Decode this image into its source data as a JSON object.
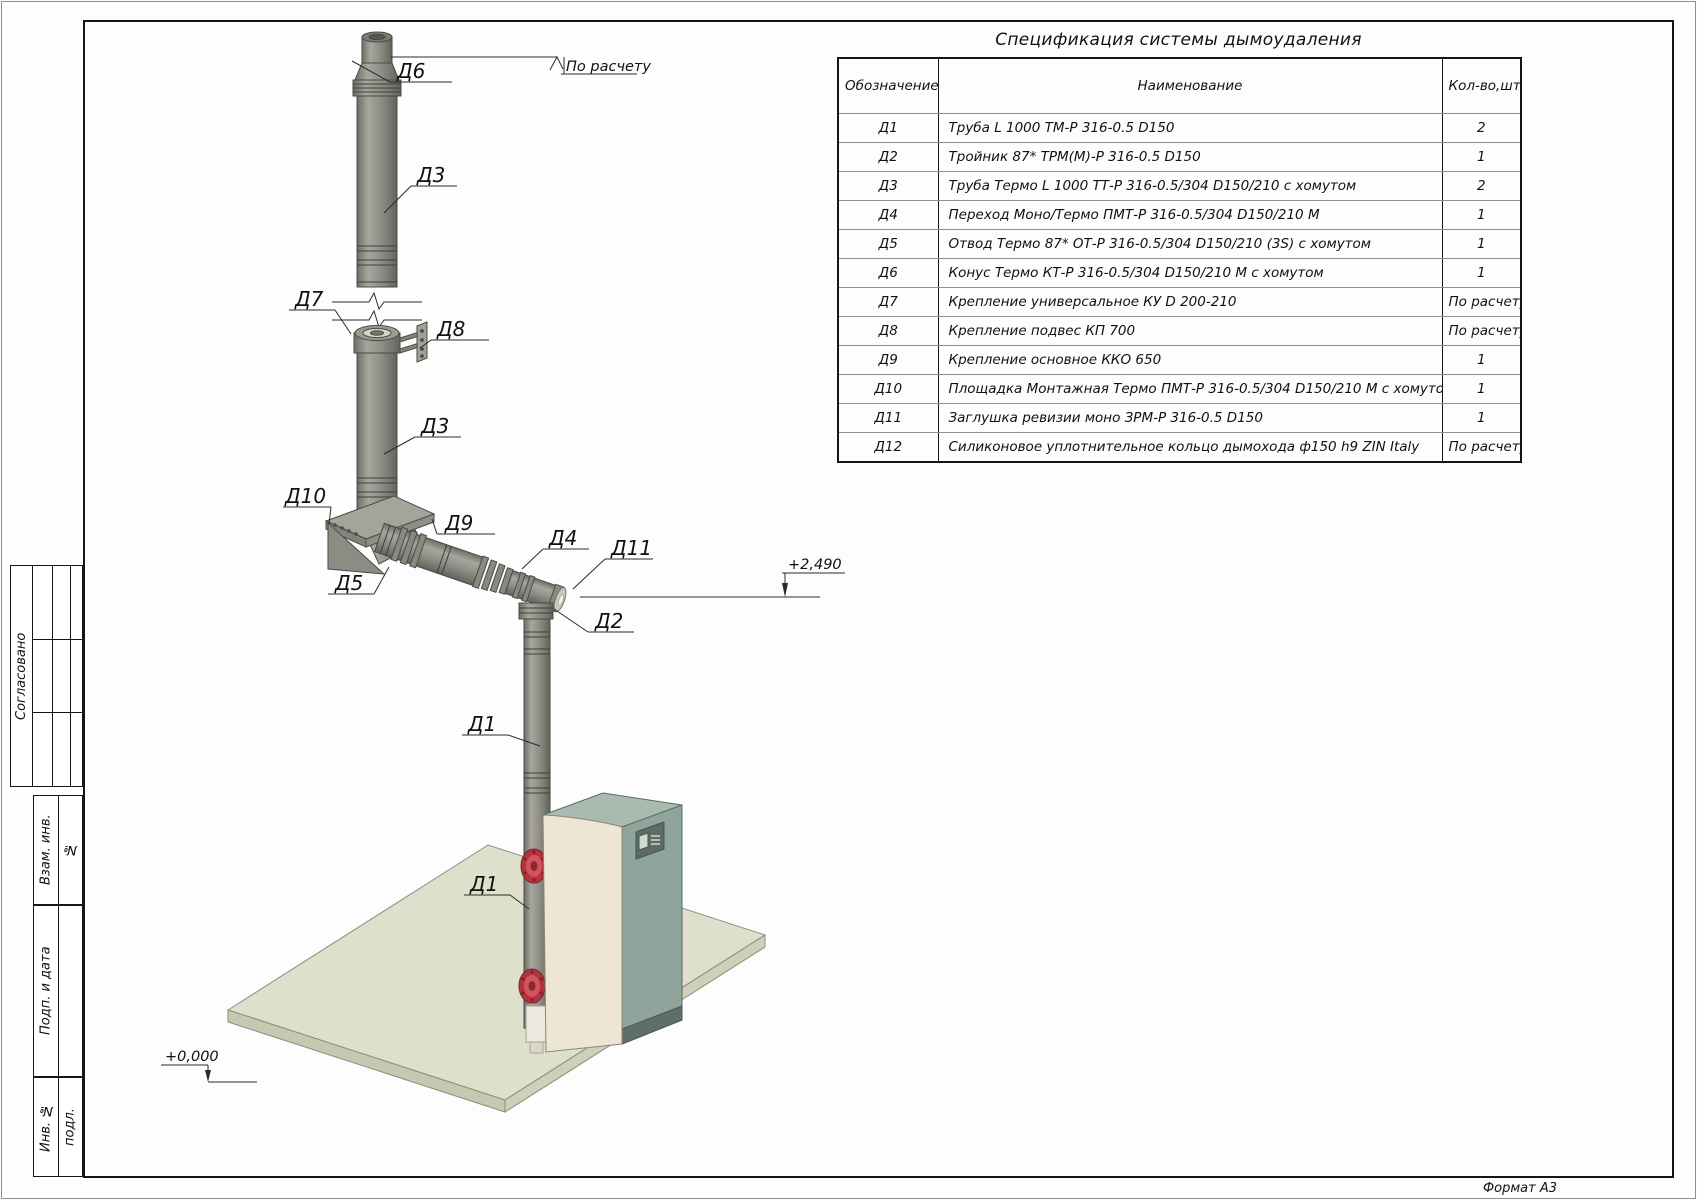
{
  "sheet": {
    "format_label": "Формат А3"
  },
  "title_block_left": {
    "approved": "Согласовано",
    "vzam_line1": "Взам. инв.",
    "vzam_line2": "№",
    "podp": "Подп. и дата",
    "inv": "Инв. №",
    "inv_sub": "подл."
  },
  "spec_table": {
    "title": "Спецификация системы дымоудаления",
    "headers": {
      "code": "Обозначение",
      "name": "Наименование",
      "qty": "Кол-во,шт"
    },
    "rows": [
      {
        "code": "Д1",
        "name": "Труба L 1000 ТМ-Р 316-0.5 D150",
        "qty": "2"
      },
      {
        "code": "Д2",
        "name": "Тройник 87* ТРМ(М)-Р 316-0.5 D150",
        "qty": "1"
      },
      {
        "code": "Д3",
        "name": "Труба Термо L 1000 ТТ-Р 316-0.5/304 D150/210 с хомутом",
        "qty": "2"
      },
      {
        "code": "Д4",
        "name": "Переход Моно/Термо ПМТ-Р 316-0.5/304 D150/210 М",
        "qty": "1"
      },
      {
        "code": "Д5",
        "name": "Отвод Термо 87* ОТ-Р 316-0.5/304 D150/210 (3S) с хомутом",
        "qty": "1"
      },
      {
        "code": "Д6",
        "name": "Конус Термо КТ-Р 316-0.5/304 D150/210 М с хомутом",
        "qty": "1"
      },
      {
        "code": "Д7",
        "name": "Крепление универсальное КУ D 200-210",
        "qty": "По расчету"
      },
      {
        "code": "Д8",
        "name": "Крепление подвес КП 700",
        "qty": "По расчету"
      },
      {
        "code": "Д9",
        "name": "Крепление основное ККО 650",
        "qty": "1"
      },
      {
        "code": "Д10",
        "name": "Площадка Монтажная Термо ПМТ-Р 316-0.5/304 D150/210 М с хомутом",
        "qty": "1"
      },
      {
        "code": "Д11",
        "name": "Заглушка ревизии моно ЗРМ-Р 316-0.5 D150",
        "qty": "1"
      },
      {
        "code": "Д12",
        "name": "Силиконовое уплотнительное кольцо дымохода ф150 h9 ZIN Italy",
        "qty": "По расчету"
      }
    ]
  },
  "drawing": {
    "top_note": "По расчету",
    "elevation_top": "+2,490",
    "elevation_floor": "+0,000",
    "callouts": {
      "d6": "Д6",
      "d3_upper": "Д3",
      "d7": "Д7",
      "d8": "Д8",
      "d3_lower": "Д3",
      "d10": "Д10",
      "d9": "Д9",
      "d5": "Д5",
      "d4": "Д4",
      "d11": "Д11",
      "d2": "Д2",
      "d1_upper": "Д1",
      "d1_lower": "Д1"
    }
  },
  "colors": {
    "pipe_grey": "#8f8e86",
    "pipe_edge": "#4c4b45",
    "boiler_front": "#ede6d4",
    "boiler_side": "#8fa49b",
    "boiler_top": "#a9bab1",
    "flange_red": "#b5333d",
    "floor_top": "#dfe0cc",
    "line": "#1a1a1a"
  }
}
